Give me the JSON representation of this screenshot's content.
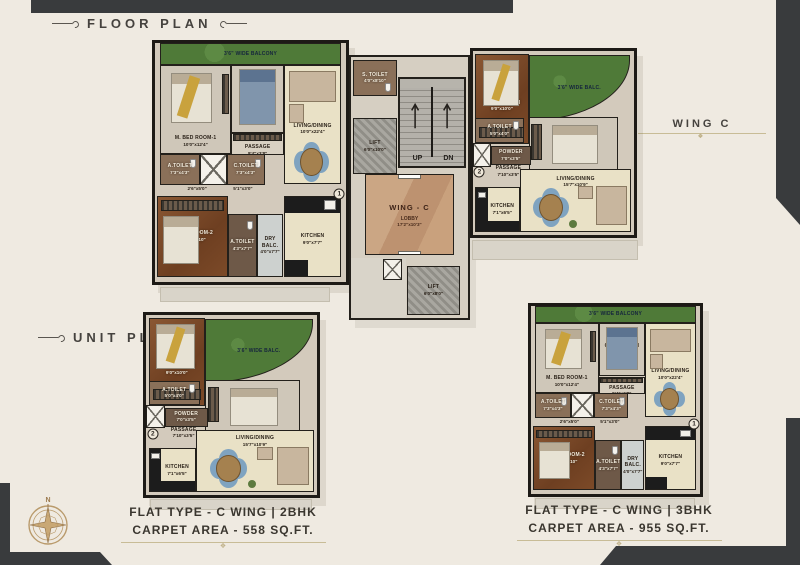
{
  "header": {
    "floor_plan_label": "FLOOR PLAN",
    "unit_plan_label": "UNIT PLAN",
    "wing_label": "WING C"
  },
  "compass": {
    "north_label": "N"
  },
  "core": {
    "s_toilet": {
      "name": "S. TOILET",
      "dims": "4'0\"x8'10\""
    },
    "lift_main": {
      "name": "LIFT",
      "dims": "6'0\"x10'0\""
    },
    "stairs": {
      "up": "UP",
      "dn": "DN"
    },
    "lobby": {
      "title": "WING - C",
      "name": "LOBBY",
      "dims": "17'2\"x10'3\""
    },
    "lift_rear": {
      "name": "LIFT",
      "dims": "6'0\"x8'0\""
    }
  },
  "bhk3": {
    "marker": "1",
    "balcony": {
      "name": "3'6\" WIDE BALCONY"
    },
    "m_bed_1": {
      "name": "M. BED ROOM-1",
      "dims": "10'0\"x12'4\""
    },
    "c_bed": {
      "name": "C.BED ROOM",
      "dims": "8'3\"x9'0\""
    },
    "living": {
      "name": "LIVING/DINING",
      "dims": "10'0\"x22'4\""
    },
    "passage": {
      "name": "PASSAGE",
      "dims": "8'4\"x3'8\""
    },
    "a_toilet": {
      "name": "A.TOILET",
      "dims": "7'3\"x4'3\""
    },
    "c_toilet": {
      "name": "C.TOILET",
      "dims": "7'3\"x4'3\""
    },
    "pass_dim_a": "2'6\"x5'0\"",
    "pass_dim_b": "5'1\"x3'0\"",
    "m_bed_2": {
      "name": "M. BED ROOM-2",
      "dims": "10'0\"x12'10\""
    },
    "a_toilet_2": {
      "name": "A.TOILET",
      "dims": "4'3\"x7'7\""
    },
    "dry_balc": {
      "name": "DRY BALC.",
      "dims": "4'0\"x7'7\""
    },
    "kitchen": {
      "name": "KITCHEN",
      "dims": "9'0\"x7'7\""
    }
  },
  "bhk2": {
    "marker": "2",
    "balcony": {
      "name": "3'6\" WIDE BALC."
    },
    "m_bed": {
      "name": "M. BED ROOM",
      "dims": "9'0\"x10'0\""
    },
    "c_bed": {
      "name": "C. BED ROOM",
      "dims": "10'0\"x8'10\""
    },
    "a_toilet": {
      "name": "A.TOILET",
      "dims": "5'0\"x4'0\""
    },
    "powder": {
      "name": "POWDER",
      "dims": "7'0\"x3'5\""
    },
    "passage": {
      "name": "PASSAGE",
      "dims": "7'10\"x3'5\""
    },
    "kitchen": {
      "name": "KITCHEN",
      "dims": "7'1\"x6'5\""
    },
    "living": {
      "name": "LIVING/DINING",
      "dims": "15'7\"x10'9\""
    }
  },
  "captions": {
    "unit_2bhk": {
      "line1": "FLAT TYPE - C WING | 2BHK",
      "line2": "CARPET AREA - 558 SQ.FT."
    },
    "unit_3bhk": {
      "line1": "FLAT TYPE - C WING | 3BHK",
      "line2": "CARPET AREA - 955 SQ.FT."
    }
  },
  "colors": {
    "background": "#efeae1",
    "corner_dark": "#393b3d",
    "wall": "#23201b",
    "balcony_green": "#4f7a38",
    "wood_floor": "#7c4a28",
    "lobby_tan": "#c49c79",
    "accent_gold": "#c8bc96"
  }
}
